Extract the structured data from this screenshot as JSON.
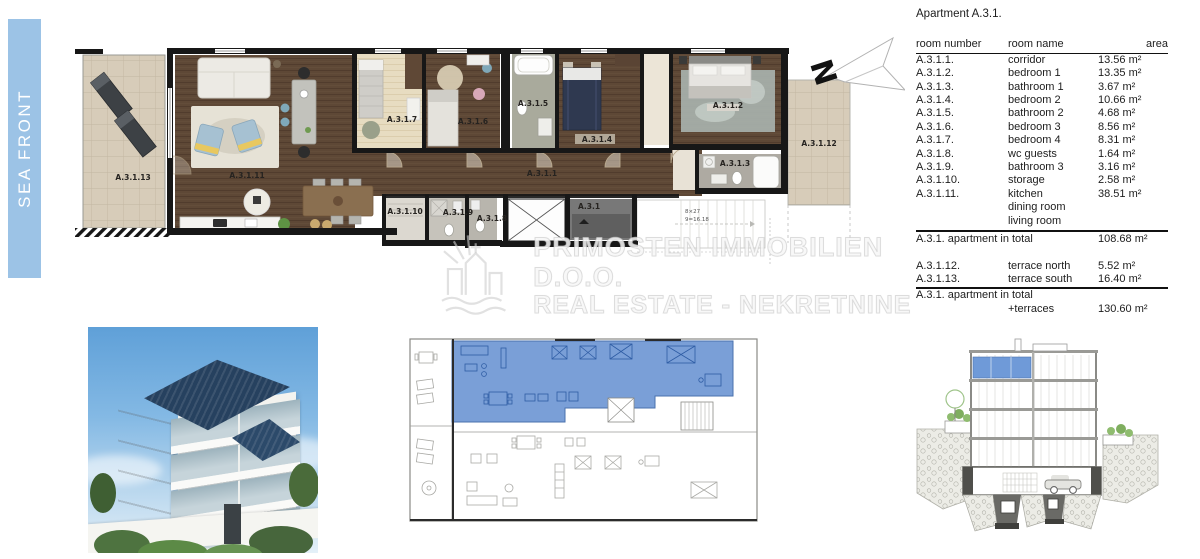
{
  "side_band": {
    "label": "SEA FRONT"
  },
  "watermark": {
    "line1": "Primosten Immobilien d.o.o.",
    "line2": "Real Estate - Nekretnine"
  },
  "compass": {
    "label": "N"
  },
  "floor_plan": {
    "labels": {
      "terrace_south": "A.3.1.13",
      "living": "A.3.1.11",
      "bedroom4": "A.3.1.7",
      "bedroom3": "A.3.1.6",
      "bathroom2": "A.3.1.5",
      "bedroom2": "A.3.1.4",
      "bedroom1": "A.3.1.2",
      "bathroom1": "A.3.1.3",
      "terrace_north": "A.3.1.12",
      "corridor": "A.3.1.1",
      "storage": "A.3.1.10",
      "bathroom3": "A.3.1.9",
      "wc_guests": "A.3.1.8",
      "entrance": "A.3.1"
    },
    "stairs": {
      "note1": "8×27",
      "note2": "9=16.18"
    }
  },
  "area_table": {
    "title": "Apartment A.3.1.",
    "headers": [
      "room number",
      "room name",
      "area"
    ],
    "rows": [
      [
        "A.3.1.1.",
        "corridor",
        "13.56 m²"
      ],
      [
        "A.3.1.2.",
        "bedroom 1",
        "13.35 m²"
      ],
      [
        "A.3.1.3.",
        "bathroom 1",
        "3.67 m²"
      ],
      [
        "A.3.1.4.",
        "bedroom 2",
        "10.66 m²"
      ],
      [
        "A.3.1.5.",
        "bathroom 2",
        "4.68 m²"
      ],
      [
        "A.3.1.6.",
        "bedroom 3",
        "8.56 m²"
      ],
      [
        "A.3.1.7.",
        "bedroom 4",
        "8.31 m²"
      ],
      [
        "A.3.1.8.",
        "wc guests",
        "1.64 m²"
      ],
      [
        "A.3.1.9.",
        "bathroom 3",
        "3.16 m²"
      ],
      [
        "A.3.1.10.",
        "storage",
        "2.58 m²"
      ],
      [
        "A.3.1.11.",
        "kitchen",
        "38.51 m²"
      ],
      [
        "",
        "dining room",
        ""
      ],
      [
        "",
        "living room",
        ""
      ]
    ],
    "total_label": "A.3.1. apartment in total",
    "total_value": "108.68 m²",
    "terrace_rows": [
      [
        "A.3.1.12.",
        "terrace north",
        "5.52 m²"
      ],
      [
        "A.3.1.13.",
        "terrace south",
        "16.40 m²"
      ]
    ],
    "grand_total_label": "A.3.1. apartment in total",
    "grand_total_sublabel": "+terraces",
    "grand_total_value": "130.60 m²"
  },
  "colors": {
    "highlight_blue": "#7098d4",
    "band_blue": "#9cc3e6"
  }
}
